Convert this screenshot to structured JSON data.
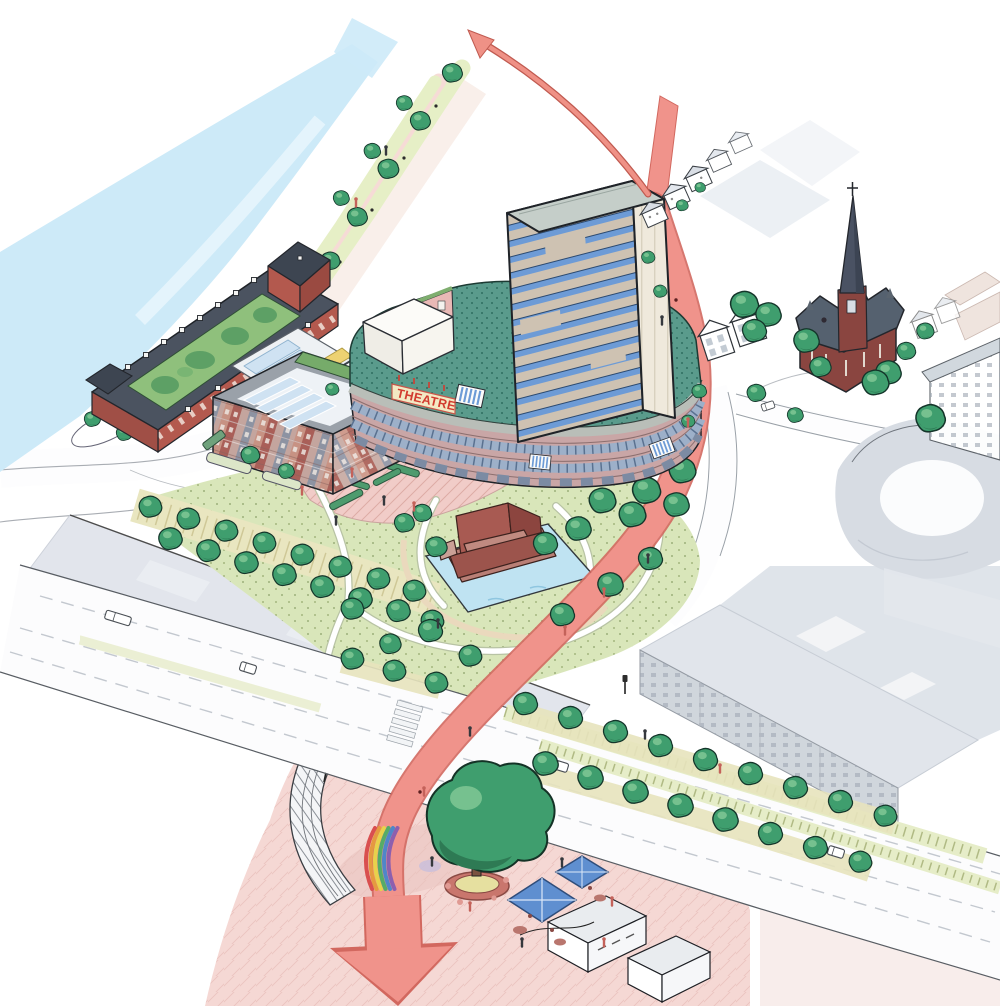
{
  "scene": {
    "type": "illustration",
    "sign_text": "THEATRE"
  },
  "colors": {
    "river": "#cdeaf8",
    "route": "#f0938b",
    "route_dark": "#d2685f",
    "arrow": "#ef9186",
    "tree": "#3f9e6e",
    "tree_dark": "#2e7a54",
    "tree_light": "#7cc492",
    "lawn": "#d9e6ba",
    "verge": "#e9e6c0",
    "plaza": "#f5d8d4",
    "plaza_shadow": "#e9c4c0",
    "brick": "#b3594e",
    "slate": "#4b5360",
    "church_brick": "#8a4540",
    "church_roof": "#55616f",
    "tower_wall": "#cec2b2",
    "tower_side": "#efe9dc",
    "tower_win": "#6d9bd6",
    "podium_green": "#5a9b8c",
    "fascia": "#b9beb8",
    "curved_face": "#c9a6a6",
    "window_band": "#9db0c9",
    "sign_bg": "#f3e9c4",
    "sign_red": "#d23b2f",
    "glass": "#cfe2f2",
    "context": "#dfe3ea",
    "ghost_line": "#e3bab4",
    "pond": "#bfe3f2",
    "sculpt": "#a85a52",
    "sculpt_dark": "#8c453f",
    "umbrella": "#5f8fd0",
    "rainbow": [
      "#d94f4f",
      "#e59a40",
      "#e8d24b",
      "#55ac67",
      "#4f86c9",
      "#8d5fae"
    ]
  }
}
